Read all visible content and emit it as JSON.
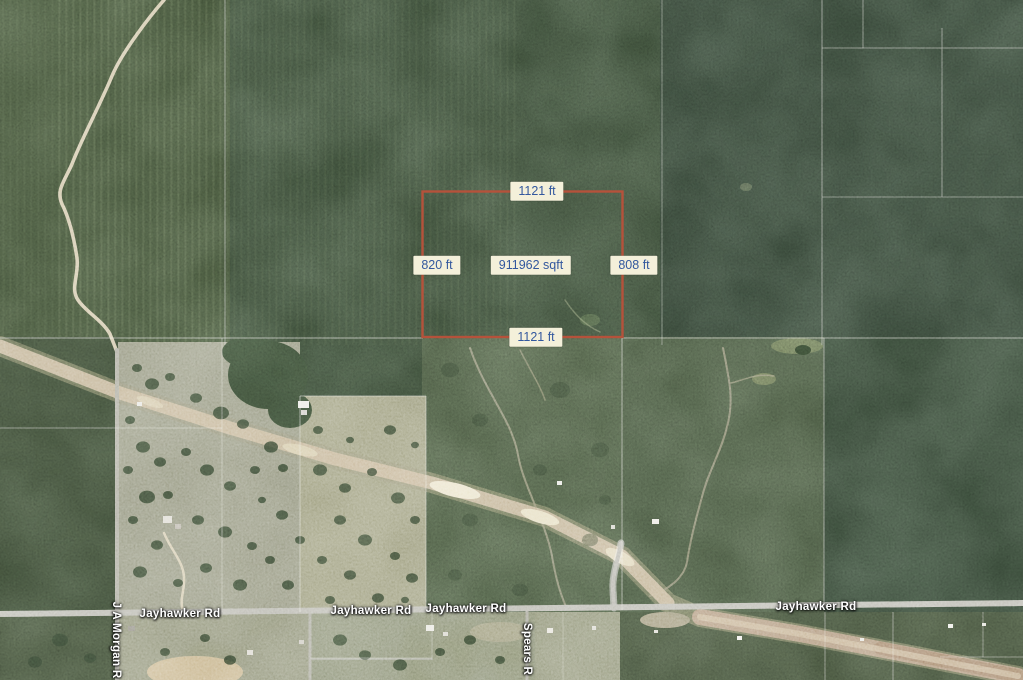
{
  "parcel": {
    "top": "1121 ft",
    "bottom": "1121 ft",
    "left": "820 ft",
    "right": "808 ft",
    "area": "911962 sqft",
    "outline_color": "#b5523b"
  },
  "roads": {
    "jayhawker": "Jayhawker Rd",
    "ja_morgan": "J A Morgan R",
    "spears": "Spears R"
  },
  "colors": {
    "measure_label_bg": "#f4f0da",
    "measure_label_text": "#33589e",
    "road_label_text": "#ffffff"
  }
}
